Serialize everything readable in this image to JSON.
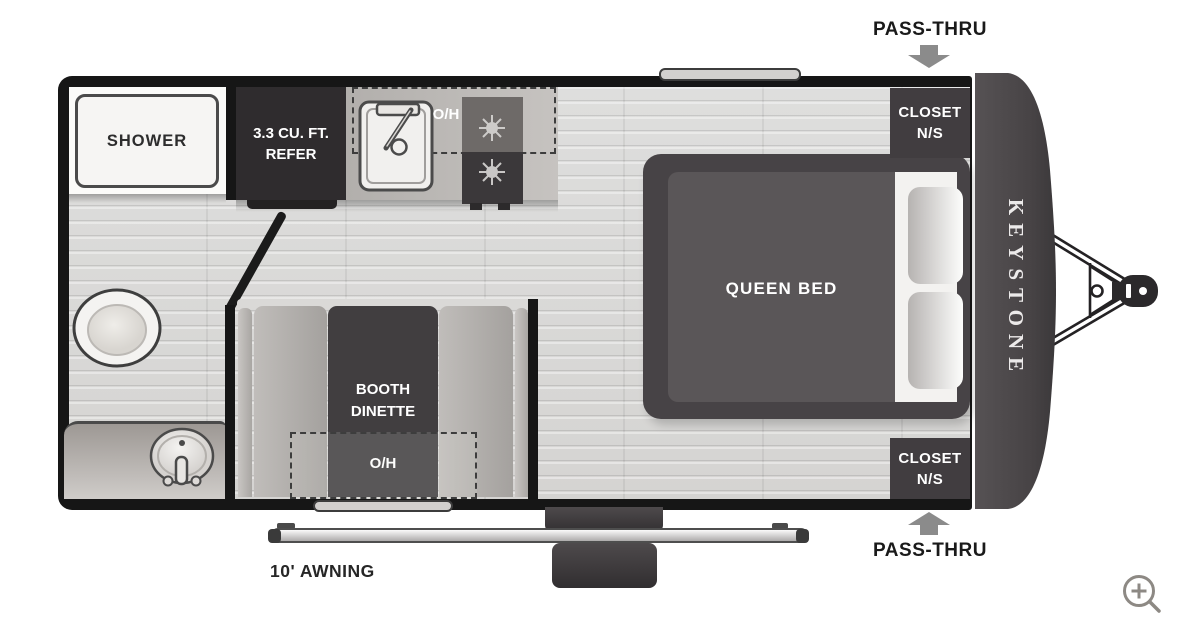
{
  "floorplan": {
    "brand_label": "KEYSTONE",
    "rooms": {
      "shower_label": "SHOWER",
      "refer_line1": "3.3 CU. FT.",
      "refer_line2": "REFER",
      "kitchen_overhead_label": "O/H",
      "queen_bed_label": "QUEEN BED",
      "closet_top_line1": "CLOSET",
      "closet_top_line2": "N/S",
      "closet_bottom_line1": "CLOSET",
      "closet_bottom_line2": "N/S",
      "dinette_line1": "BOOTH",
      "dinette_line2": "DINETTE",
      "dinette_overhead_label": "O/H"
    },
    "annotations": {
      "pass_thru_top": "PASS-THRU",
      "pass_thru_bottom": "PASS-THRU",
      "awning_label": "10' AWNING"
    },
    "icons": {
      "pass_thru_arrow": "gray-block-arrow",
      "zoom_control": "magnifier-plus"
    },
    "colors": {
      "wall": "#161616",
      "dark_furniture": "#3e3b3d",
      "floor": "#dcdbd9",
      "counter_gray": "#b7b4b1",
      "arrow_gray": "#8b8b8b",
      "label_light": "#ffffff",
      "label_dark": "#1a1a1a"
    }
  }
}
